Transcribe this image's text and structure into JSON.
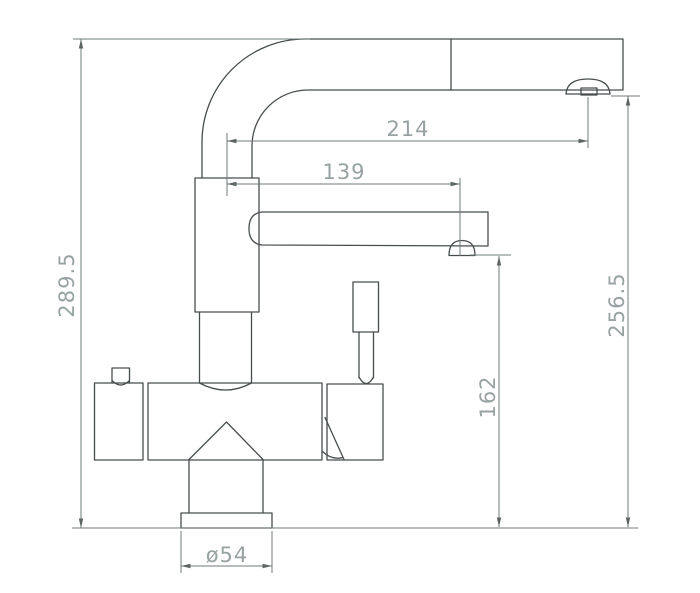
{
  "diagram": {
    "type": "technical-drawing",
    "colors": {
      "background": "#ffffff",
      "outline": "#474d4e",
      "dimension_lines": "#6f7878",
      "dimension_text": "#98a2a2"
    },
    "dimensions": {
      "overall_height": {
        "label": "289.5"
      },
      "top_spout_reach": {
        "label": "214"
      },
      "lower_spout_reach": {
        "label": "139"
      },
      "lower_spout_outlet_height": {
        "label": "162"
      },
      "top_spout_outlet_height": {
        "label": "256.5"
      },
      "base_diameter": {
        "label": "ø54"
      }
    }
  }
}
